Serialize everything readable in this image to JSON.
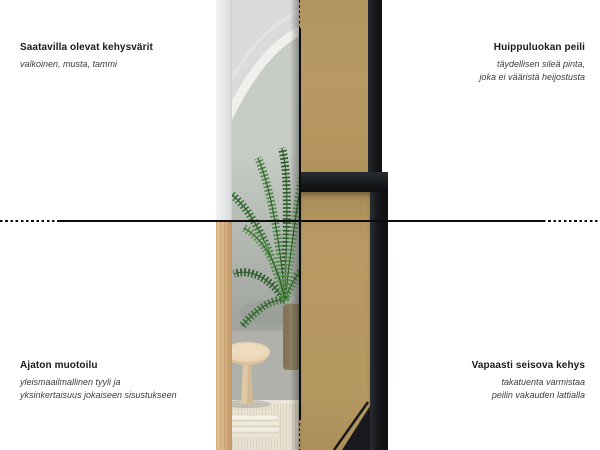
{
  "annotations": {
    "top_left": {
      "title": "Saatavilla olevat kehysvärit",
      "subtitle": "valkoinen, musta, tammi"
    },
    "top_right": {
      "title": "Huippuluokan peili",
      "subtitle_line1": "täydellisen sileä pinta,",
      "subtitle_line2": "joka ei vääristä heijostusta"
    },
    "bottom_left": {
      "title": "Ajaton muotoilu",
      "subtitle_line1": "yleismaailmallinen tyyli ja",
      "subtitle_line2": "yksinkertaisuus jokaiseen sisustukseen"
    },
    "bottom_right": {
      "title": "Vapaasti seisova kehys",
      "subtitle_line1": "takatuenta varmistaa",
      "subtitle_line2": "peilin vakauden lattialla"
    }
  },
  "image": {
    "description": "Split product photo of a full-length floor mirror: left half shows the mirror front (white frame above, oak frame below) reflecting a room with an arch, palm plant, wooden stool and rug; right half shows the free-standing back with MDF board and black frame with support",
    "colors": {
      "text": "#1a1a1a",
      "line": "#0c0c0c",
      "frame_white": "#e9e9ea",
      "frame_wood": "#d9b586",
      "frame_black": "#17191c",
      "mdf": "#b89963",
      "reflection_gray": "#c8ccc7",
      "arch_white": "#f1f0ec",
      "wall_gray": "#9fa39d",
      "floor_gray": "#b1b1ab",
      "rug_cream": "#eae3d3",
      "stool_wood": "#ead5b4",
      "plant_green": "#3d7539",
      "pot_brown": "#8f8062"
    }
  }
}
